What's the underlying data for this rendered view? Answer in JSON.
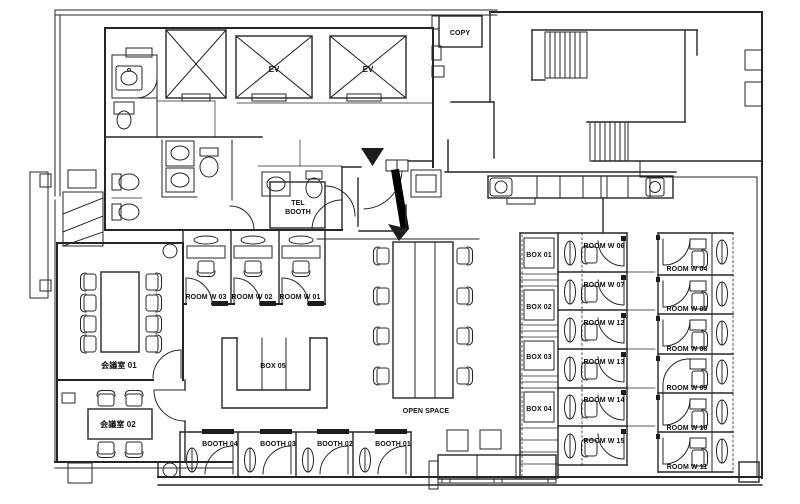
{
  "drawing": {
    "kind": "office floor plan",
    "wall_color": "#262626",
    "background_color": "#ffffff",
    "entrance_marker": "black triangle"
  },
  "labels": {
    "copy": "COPY",
    "ev_left": "EV",
    "ev_right": "EV",
    "tel_booth_line1": "TEL",
    "tel_booth_line2": "BOOTH",
    "open_space": "OPEN SPACE",
    "meeting_room_1": "会議室 01",
    "meeting_room_2": "会議室 02",
    "box_05": "BOX 05"
  },
  "small_rooms_row": [
    "ROOM W 03",
    "ROOM W 02",
    "ROOM W 01"
  ],
  "booths": [
    "BOOTH 04",
    "BOOTH 03",
    "BOOTH 02",
    "BOOTH 01"
  ],
  "box_shelves": [
    "BOX 01",
    "BOX 02",
    "BOX 03",
    "BOX 04"
  ],
  "mid_rooms": [
    "ROOM W 06",
    "ROOM W 07",
    "ROOM W 12",
    "ROOM W 13",
    "ROOM W 14",
    "ROOM W 15"
  ],
  "right_rooms": [
    "ROOM W 04",
    "ROOM W 05",
    "ROOM W 08",
    "ROOM W 09",
    "ROOM W 10",
    "ROOM W 11"
  ]
}
